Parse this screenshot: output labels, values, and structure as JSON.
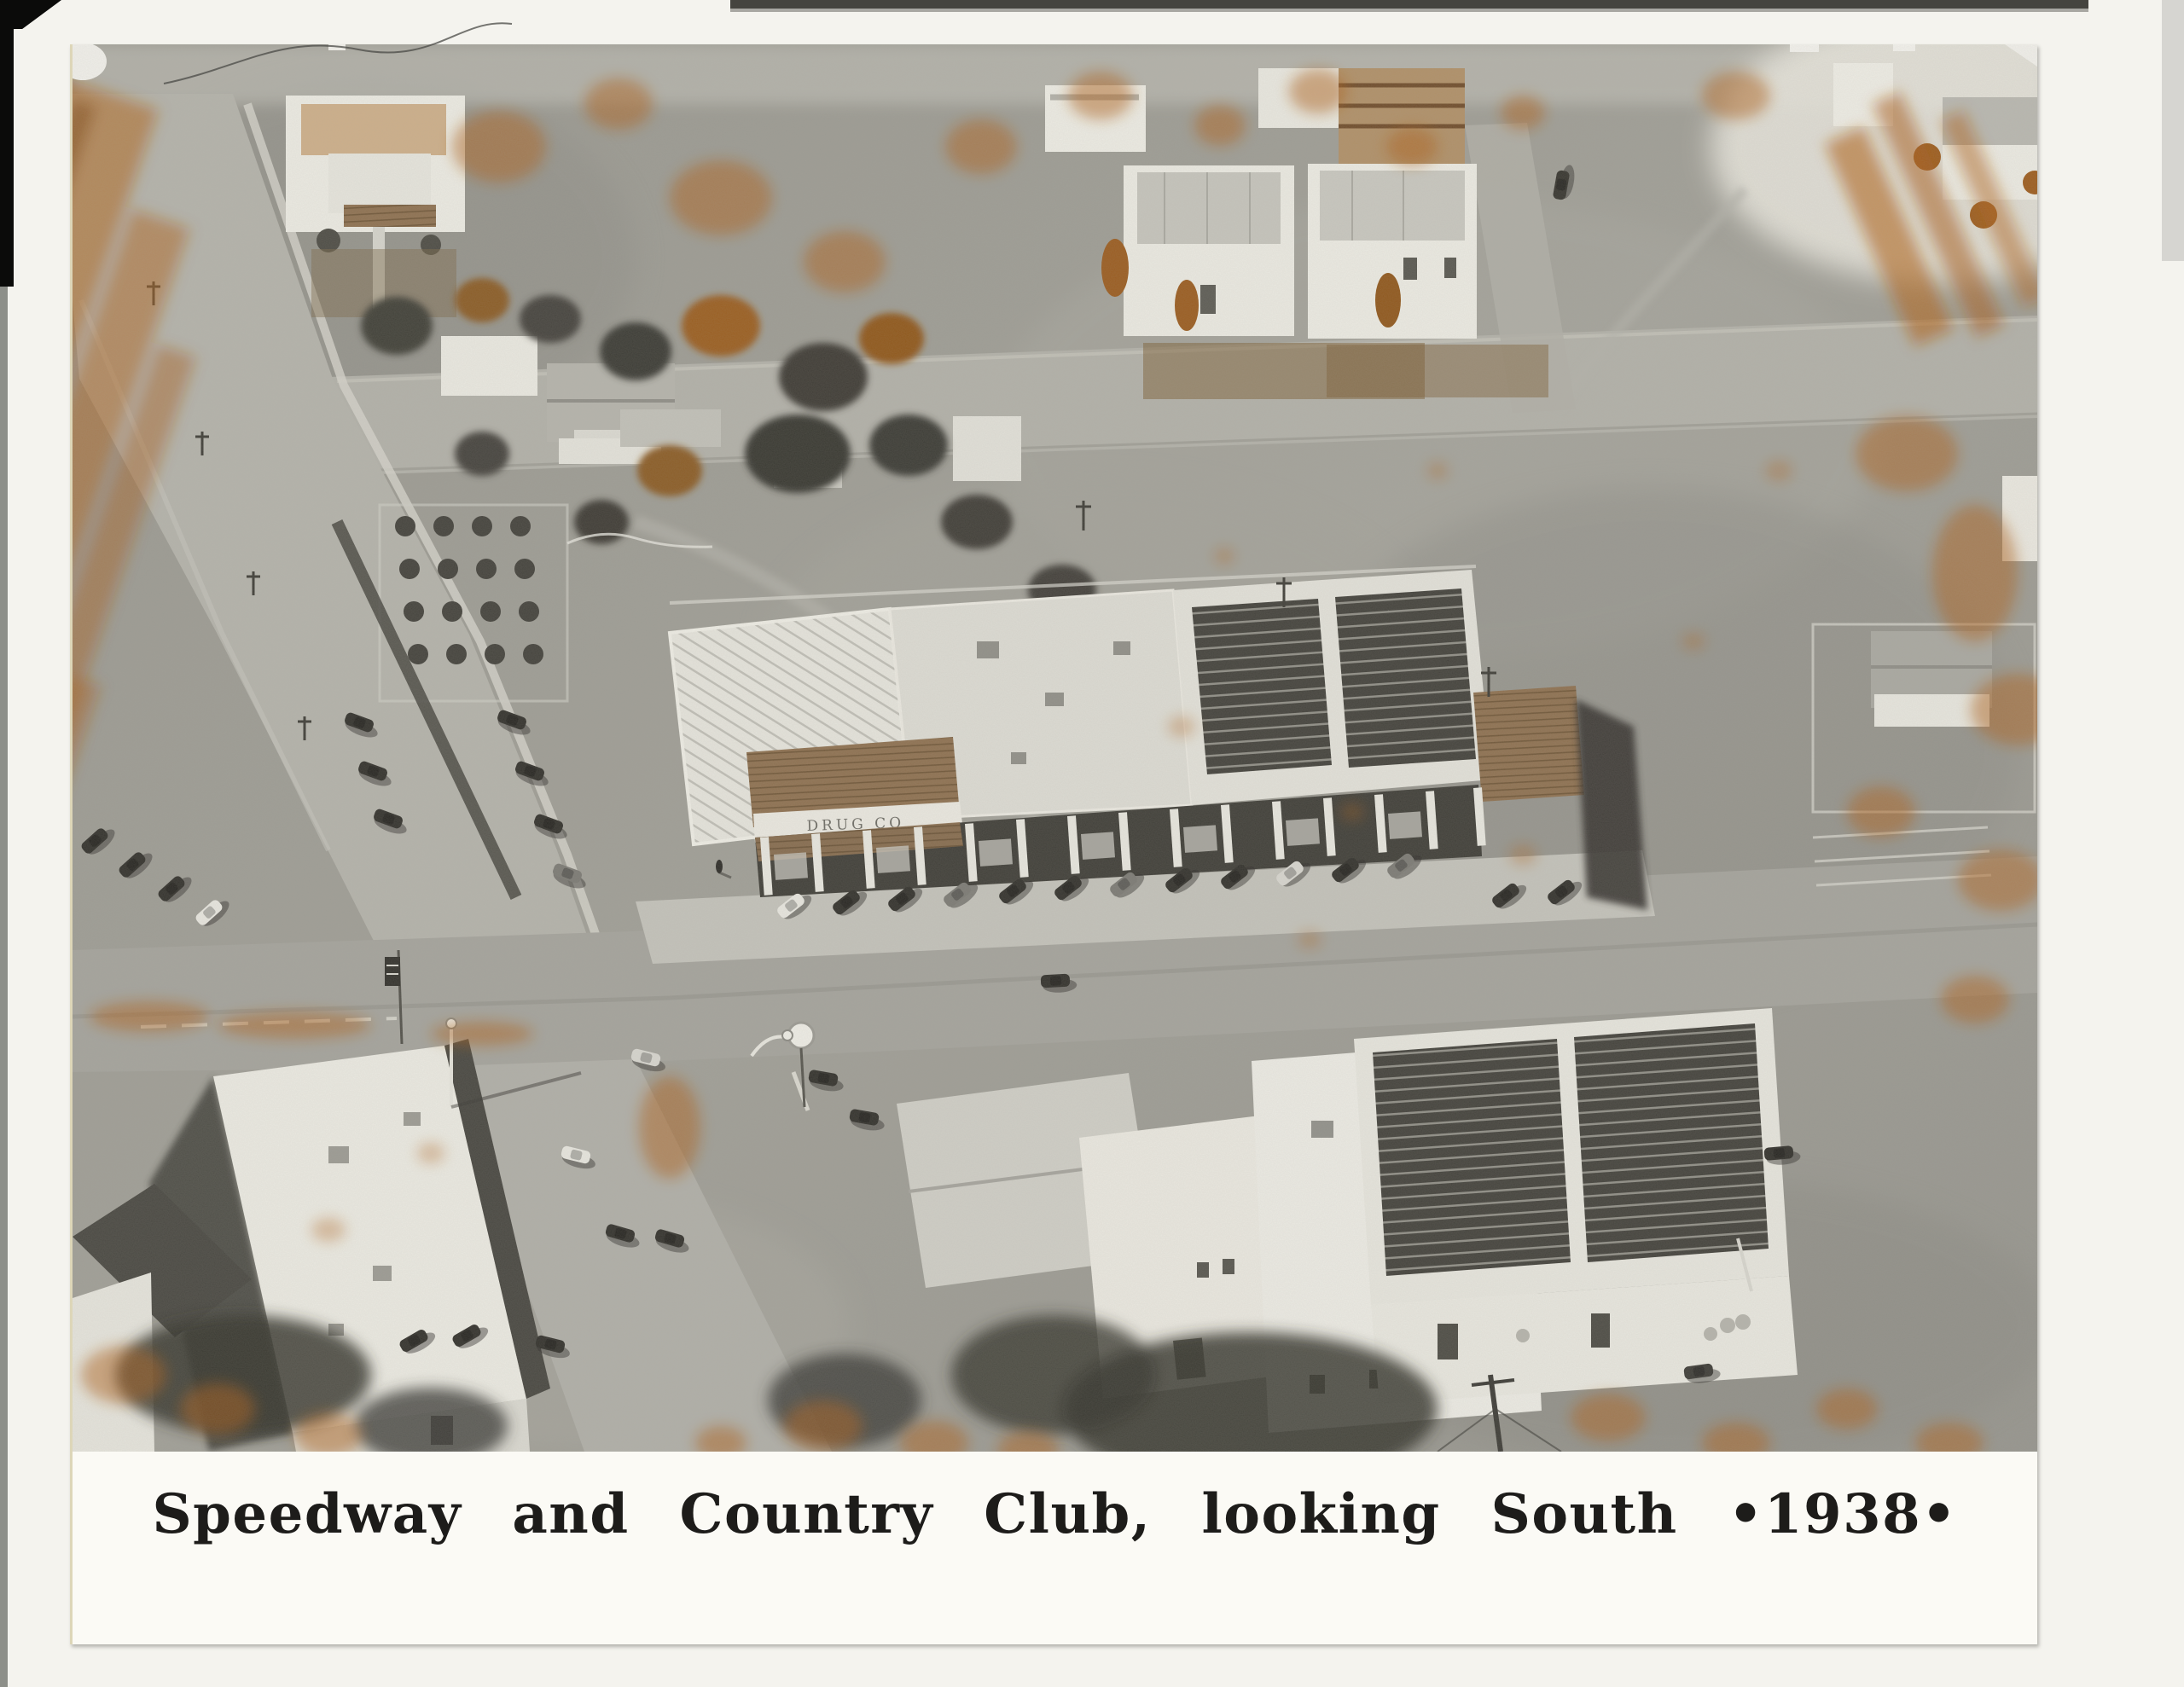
{
  "scan": {
    "background_color": "#f4f3ee",
    "print_paper_color": "#fbfaf5"
  },
  "photo_print": {
    "caption": "Speedway and Country Club, looking South •1938•",
    "year": "1938",
    "signs": {
      "drug_store": "DRUG CO"
    },
    "colors": {
      "photo_gray": "#9a9992",
      "oxidation_orange": "#b06018",
      "caption_ink": "#1d1c1a"
    }
  }
}
